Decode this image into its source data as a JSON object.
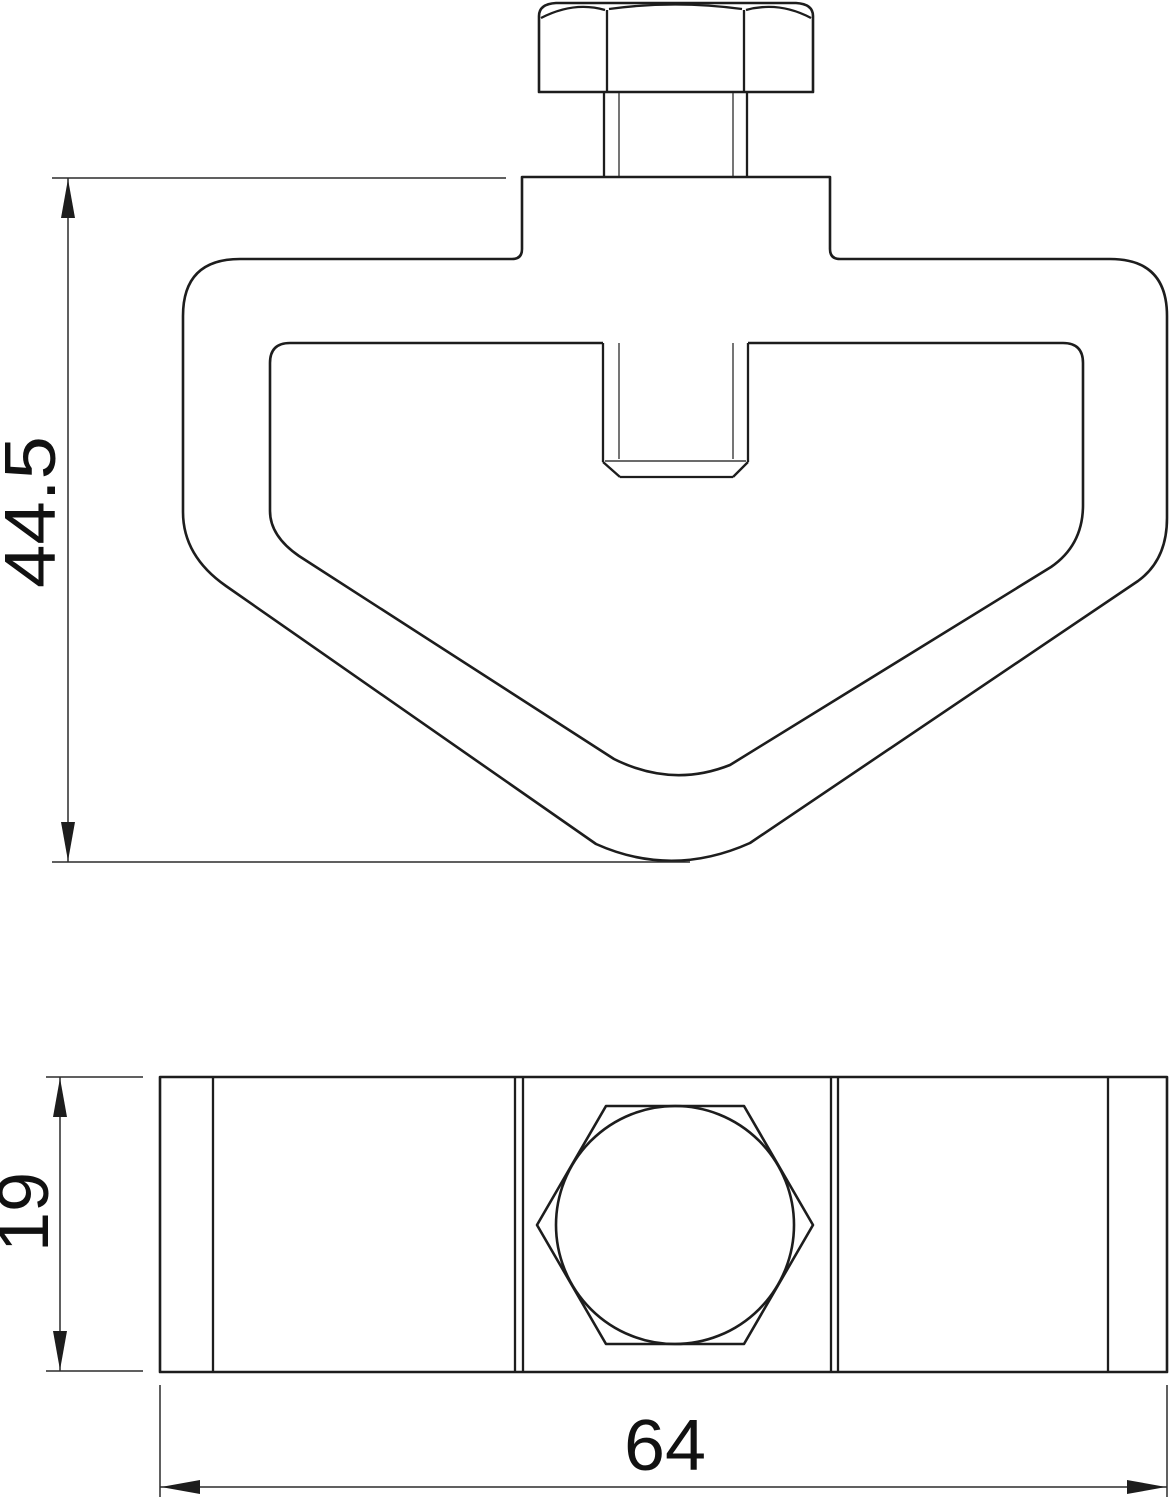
{
  "drawing": {
    "type": "technical-dimension-drawing",
    "background_color": "#ffffff",
    "line_color": "#1d1d1d",
    "text_color": "#111111",
    "views": {
      "front_view": {
        "name": "clamp front view with hex bolt",
        "features": [
          "hex-bolt-head",
          "threaded-shaft",
          "top-tab",
          "clamp-body-outline",
          "inner-cutout",
          "bolt-tip"
        ]
      },
      "bottom_view": {
        "name": "clamp bottom view",
        "features": [
          "body-rectangle",
          "hex-bolt-head-outline",
          "inscribed-circle",
          "edge-lines"
        ]
      }
    },
    "dimensions": {
      "front_height": {
        "value": "44.5",
        "orientation": "vertical"
      },
      "side_height": {
        "value": "19",
        "orientation": "vertical"
      },
      "side_width": {
        "value": "64",
        "orientation": "horizontal"
      }
    }
  }
}
